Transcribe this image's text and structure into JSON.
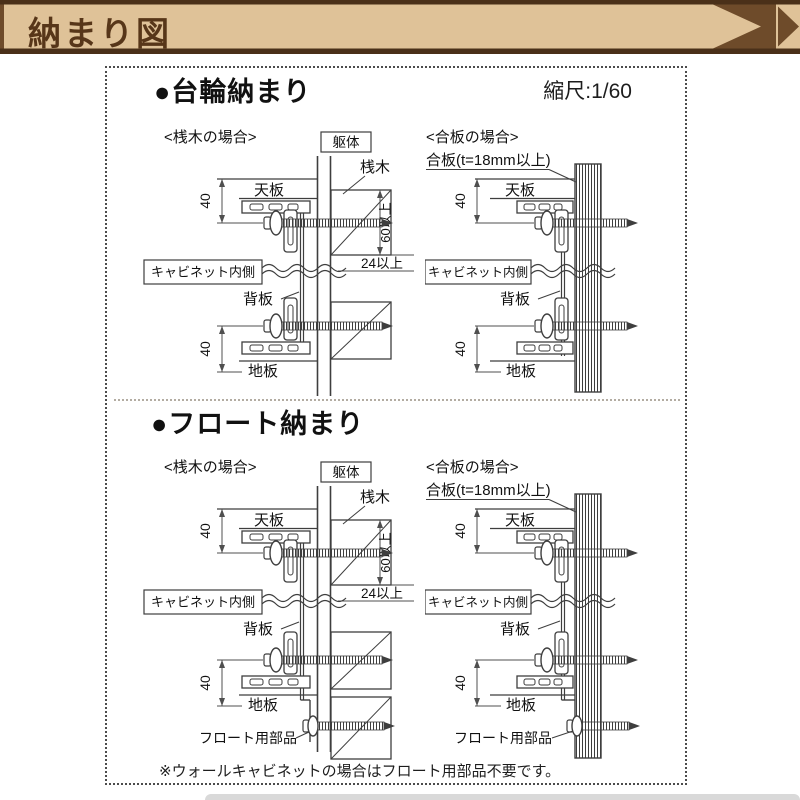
{
  "banner": {
    "title": "納まり図"
  },
  "sections": [
    {
      "heading": "●台輪納まり",
      "scale": "縮尺:1/60"
    },
    {
      "heading": "●フロート納まり"
    }
  ],
  "labels": {
    "case_batten": "<桟木の場合>",
    "case_plywood": "<合板の場合>",
    "frame": "躯体",
    "batten": "桟木",
    "plywood": "合板(t=18mm以上)",
    "top_panel": "天板",
    "back_panel": "背板",
    "bottom_panel": "地板",
    "cabinet_inside": "キャビネット内側",
    "float_part": "フロート用部品",
    "dim_40": "40",
    "dim_60_plus": "60以上",
    "dim_24_plus": "24以上"
  },
  "footnote": "※ウォールキャビネットの場合はフロート用部品不要です。",
  "colors": {
    "banner_brown": "#6e4b2a",
    "banner_dark": "#4a3019",
    "banner_tan": "#dfc298",
    "title_text": "#573619",
    "grey_edge": "#d9d9d9"
  }
}
